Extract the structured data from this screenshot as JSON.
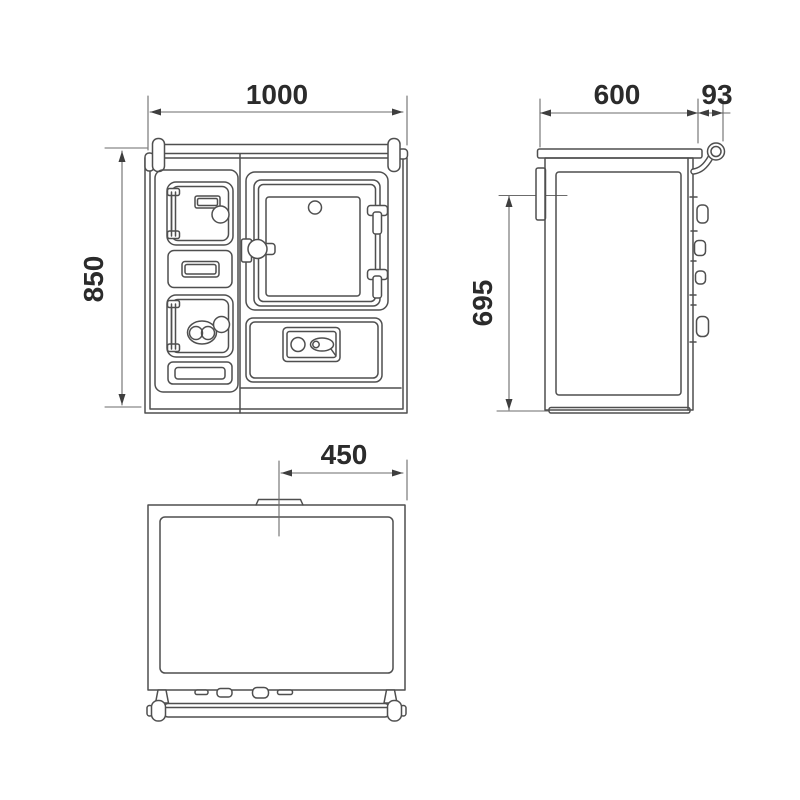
{
  "drawing": {
    "colors": {
      "line": "#4f4f4f",
      "dimension_line": "#6b6b6b",
      "text": "#2b2b2b",
      "background": "#ffffff"
    },
    "views": {
      "front": {
        "dimensions": {
          "width": "1000",
          "height": "850"
        }
      },
      "side": {
        "dimensions": {
          "depth": "600",
          "handle_offset": "93",
          "height": "695"
        }
      },
      "top": {
        "dimensions": {
          "flue_center_offset": "450"
        }
      }
    }
  }
}
